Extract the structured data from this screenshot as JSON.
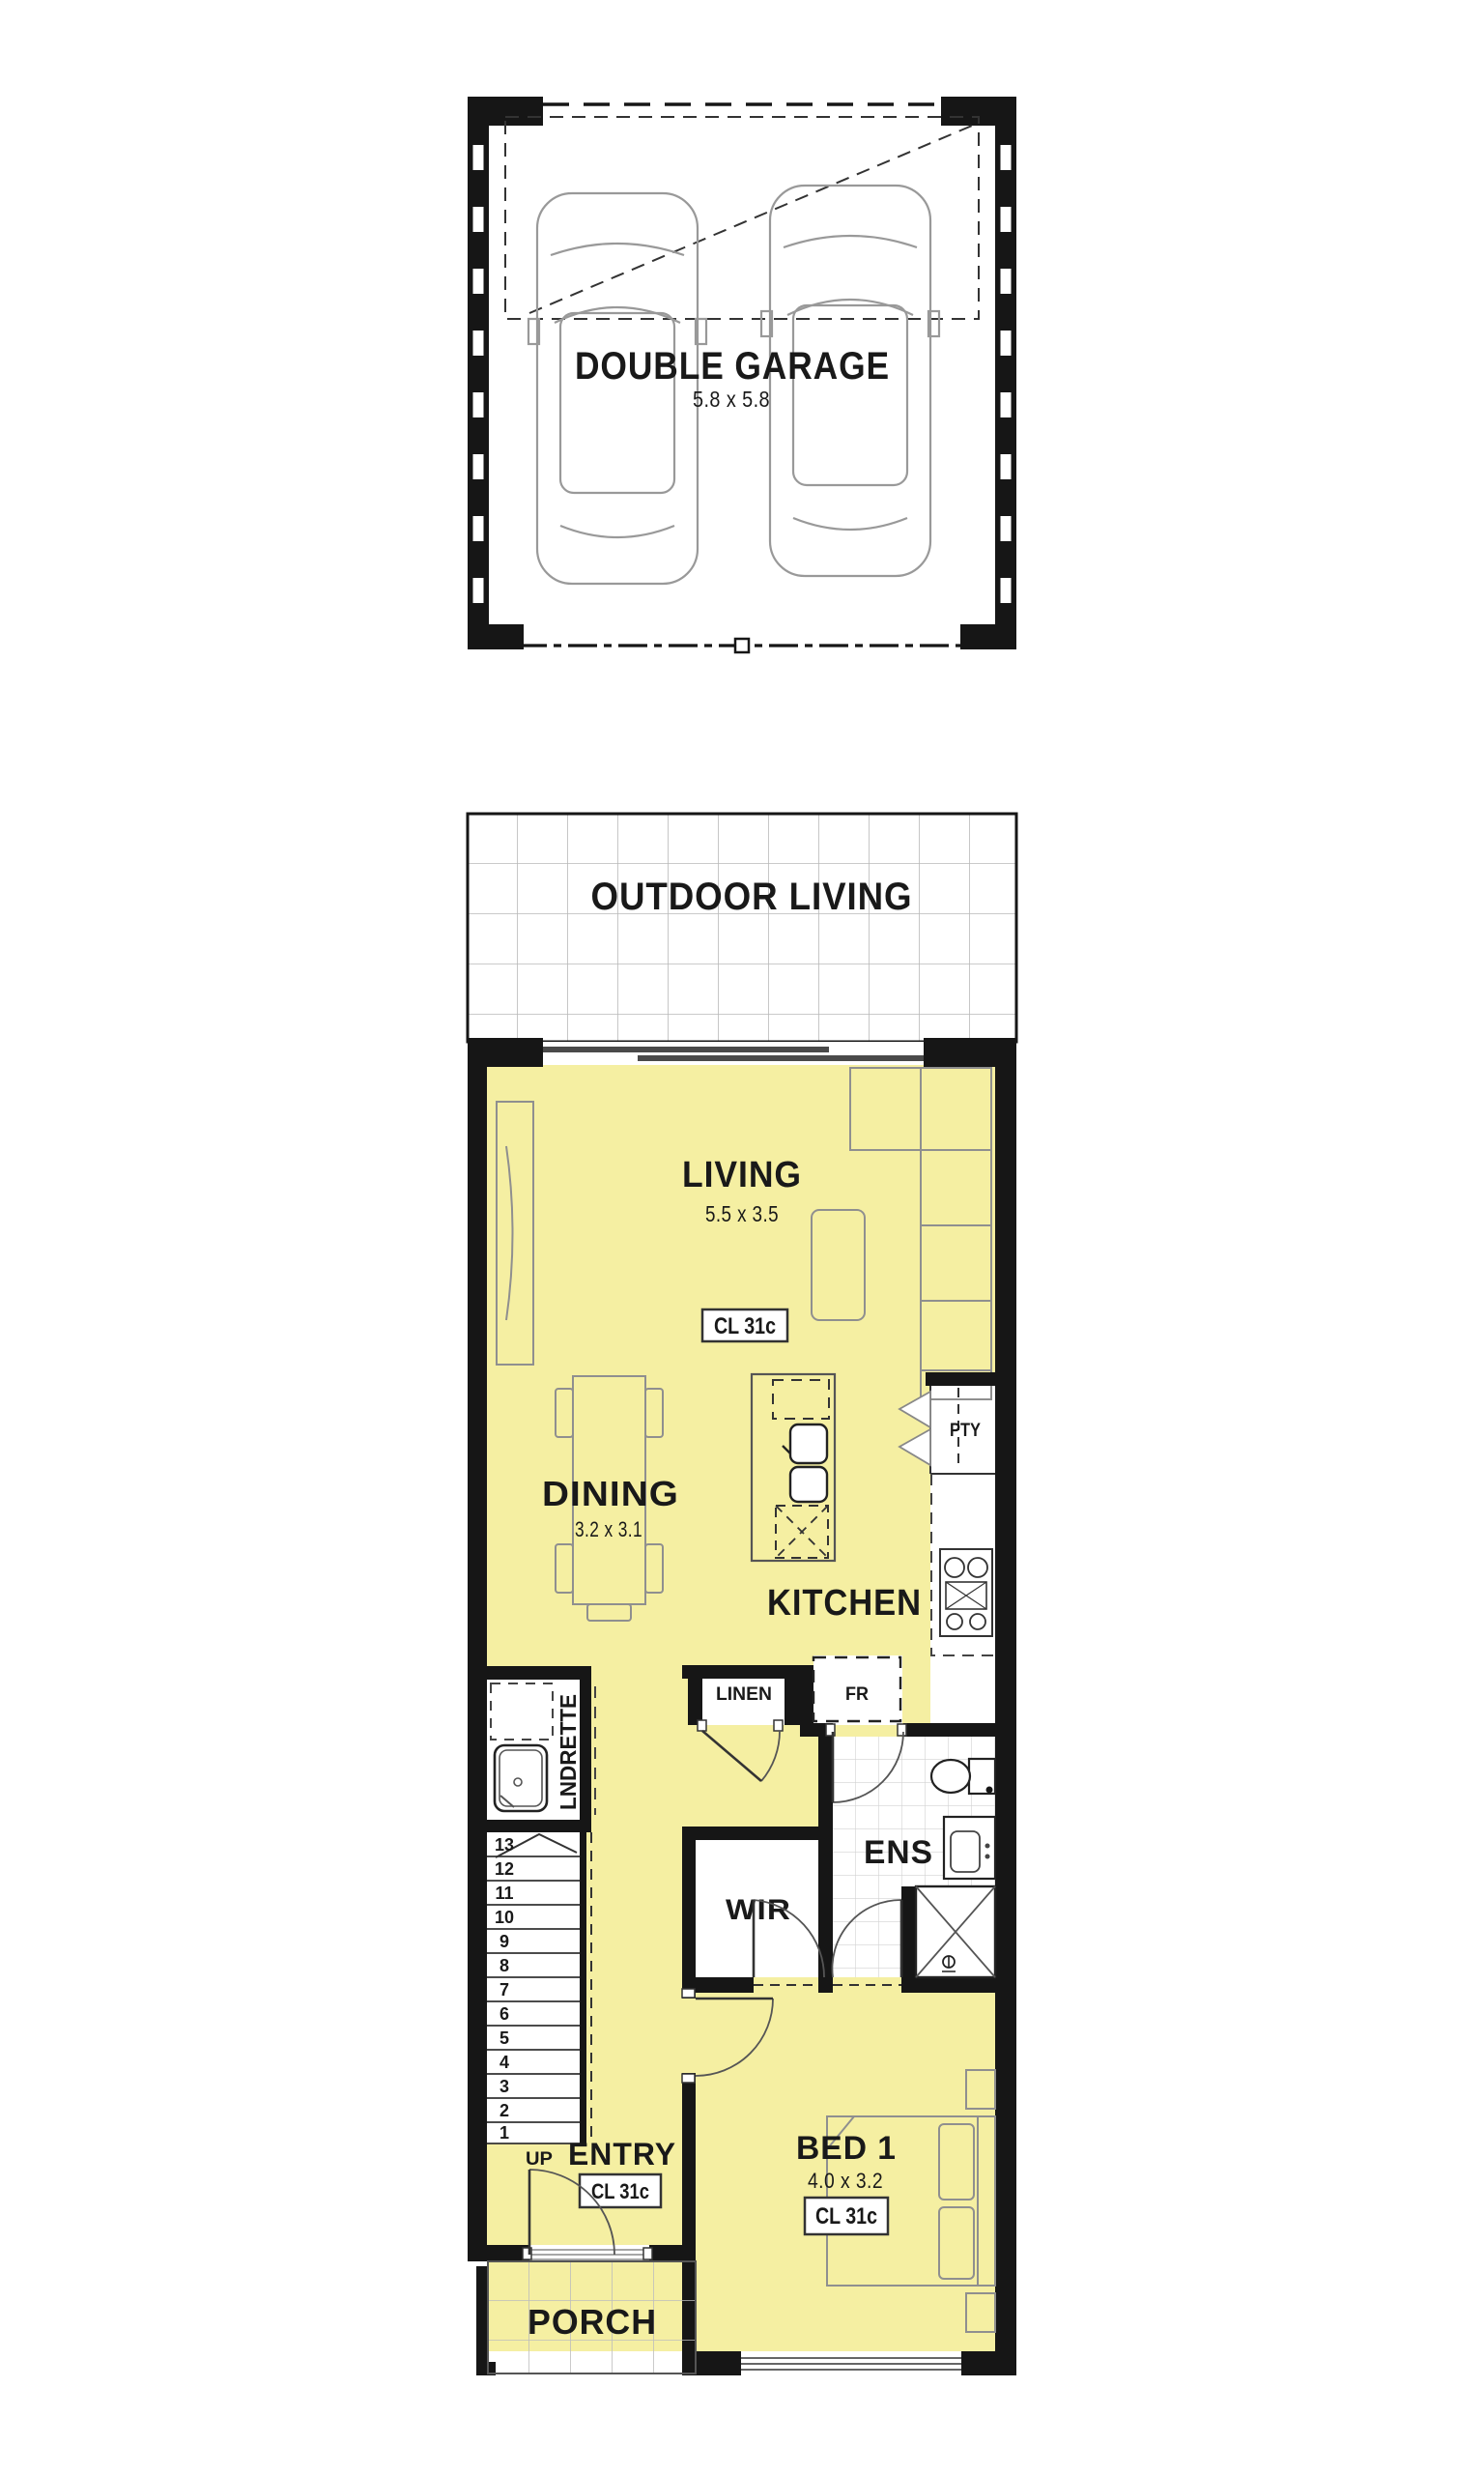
{
  "plan_title": "Single storey floor plan",
  "colors": {
    "floor_fill": "#f5efa2",
    "wall": "#161616",
    "paper": "#ffffff",
    "furniture_line": "#8f8f8f",
    "tile_line": "#c9c9c9"
  },
  "rooms": {
    "garage": {
      "label": "DOUBLE GARAGE",
      "dims": "5.8 x 5.8"
    },
    "outdoor": {
      "label": "OUTDOOR LIVING"
    },
    "living": {
      "label": "LIVING",
      "dims": "5.5 x 3.5",
      "ceiling": "CL 31c"
    },
    "dining": {
      "label": "DINING",
      "dims": "3.2 x 3.1"
    },
    "kitchen": {
      "label": "KITCHEN"
    },
    "pantry": {
      "label": "PTY"
    },
    "linen": {
      "label": "LINEN"
    },
    "fridge": {
      "label": "FR"
    },
    "laundry": {
      "label": "LNDRETTE"
    },
    "ensuite": {
      "label": "ENS"
    },
    "wir": {
      "label": "WIR"
    },
    "bed1": {
      "label": "BED 1",
      "dims": "4.0 x 3.2",
      "ceiling": "CL 31c"
    },
    "entry": {
      "label": "ENTRY",
      "ceiling": "CL 31c"
    },
    "porch": {
      "label": "PORCH"
    },
    "stairs": {
      "up": "UP",
      "treads": [
        "13",
        "12",
        "11",
        "10",
        "9",
        "8",
        "7",
        "6",
        "5",
        "4",
        "3",
        "2",
        "1"
      ]
    }
  }
}
